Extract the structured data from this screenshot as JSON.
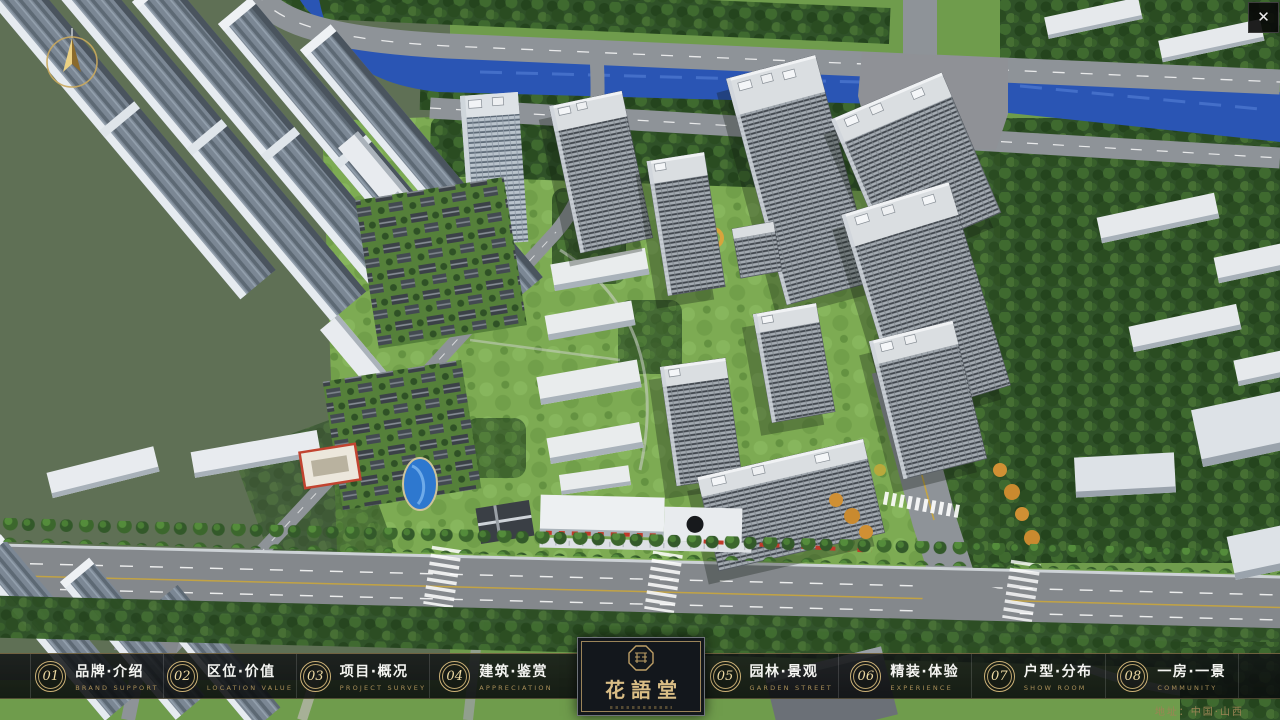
{
  "window": {
    "close_glyph": "✕"
  },
  "brand": {
    "logo_zh": "花語堂"
  },
  "navbar": {
    "items": [
      {
        "num": "01",
        "zh": "品牌·介绍",
        "en": "BRAND SUPPORT"
      },
      {
        "num": "02",
        "zh": "区位·价值",
        "en": "LOCATION VALUE"
      },
      {
        "num": "03",
        "zh": "项目·概况",
        "en": "PROJECT SURVEY"
      },
      {
        "num": "04",
        "zh": "建筑·鉴赏",
        "en": "APPRECIATION"
      },
      {
        "num": "05",
        "zh": "园林·景观",
        "en": "GARDEN STREET"
      },
      {
        "num": "06",
        "zh": "精装·体验",
        "en": "EXPERIENCE"
      },
      {
        "num": "07",
        "zh": "户型·分布",
        "en": "SHOW ROOM"
      },
      {
        "num": "08",
        "zh": "一房·一景",
        "en": "COMMUNITY"
      }
    ]
  },
  "footer": {
    "address": "地址：中国·山西"
  },
  "colors": {
    "gold_accent": "#c9ad6f",
    "bar_background": "#101214",
    "logo_text": "#d9bd85",
    "label_zh": "#f4f4f1",
    "label_en": "#a98f58",
    "river_blue": "#2a55b4",
    "canopy_green": "#2f5128",
    "road_grey": "#8e9398"
  }
}
